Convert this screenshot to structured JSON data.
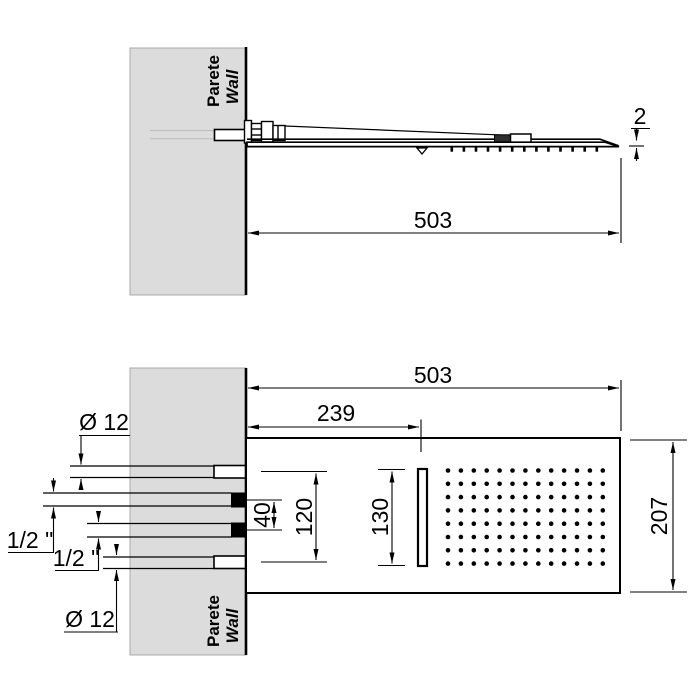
{
  "colors": {
    "wall_fill": "#dcdcdc",
    "line": "#000000"
  },
  "side_view": {
    "wall_line1": "Parete",
    "wall_line2": "Wall",
    "dim_length": "503",
    "dim_tip_thickness": "2",
    "nozzle_count": 13
  },
  "plan_view": {
    "wall_line1": "Parete",
    "wall_line2": "Wall",
    "dim_length": "503",
    "dim_slot_offset": "239",
    "dim_depth": "207",
    "dim_slot_length": "130",
    "dim_supply_span": "120",
    "dim_port_span": "40",
    "dim_pipe_top": "Ø 12",
    "dim_pipe_bottom": "Ø 12",
    "dim_port_1": "1/2 \"",
    "dim_port_2": "1/2 \"",
    "nozzle_grid": {
      "cols": 13,
      "rows": 8
    }
  }
}
